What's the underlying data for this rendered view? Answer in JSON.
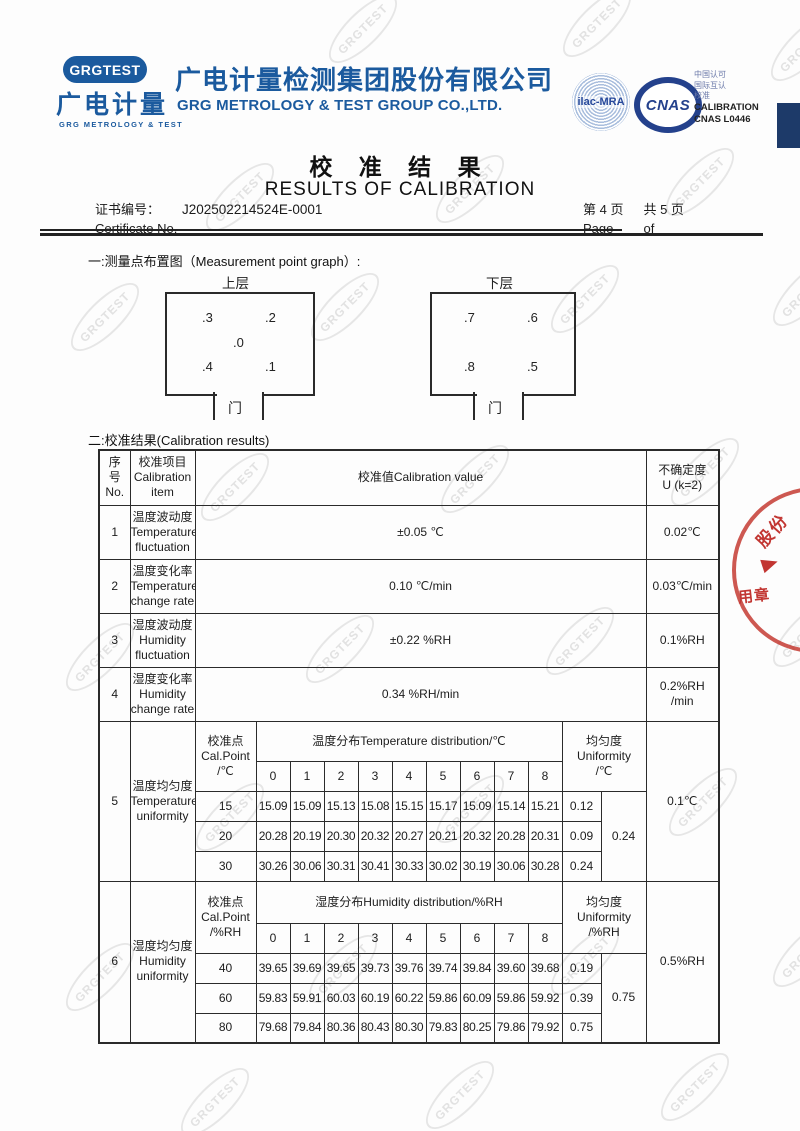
{
  "header": {
    "logo": {
      "badge": "GRGTEST",
      "cn": "广电计量",
      "en": "GRG METROLOGY & TEST"
    },
    "company": {
      "cn": "广电计量检测集团股份有限公司",
      "en": "GRG METROLOGY & TEST GROUP CO.,LTD."
    },
    "marks": {
      "ilac": "ilac-MRA",
      "cnas": "CNAS",
      "accreditation_lines": [
        "中国认可",
        "国际互认",
        "校准"
      ],
      "calibration": "CALIBRATION",
      "cnas_no": "CNAS L0446"
    }
  },
  "title": {
    "cn": "校 准 结 果",
    "en": "RESULTS OF CALIBRATION"
  },
  "certificate": {
    "label_cn": "证书编号：",
    "number": "J202502214524E-0001",
    "label_en": "Certificate No.",
    "page": {
      "first": "第 4  页",
      "second": "共 5  页",
      "page_label": "Page",
      "of_label": "of"
    }
  },
  "sections": {
    "one": "一:测量点布置图（Measurement point graph）:",
    "two": "二:校准结果(Calibration results)"
  },
  "diagram": {
    "upper": {
      "title": "上层",
      "p_tl": ".3",
      "p_tr": ".2",
      "p_c": ".0",
      "p_bl": ".4",
      "p_br": ".1",
      "door": "门"
    },
    "lower": {
      "title": "下层",
      "p_tl": ".7",
      "p_tr": ".6",
      "p_bl": ".8",
      "p_br": ".5",
      "door": "门"
    }
  },
  "table": {
    "header": {
      "no": [
        "序",
        "号",
        "No."
      ],
      "item": [
        "校准项目",
        "Calibration",
        "item"
      ],
      "value": "校准值Calibration value",
      "unc": [
        "不确定度",
        "U (k=2)"
      ]
    },
    "simple_rows": [
      {
        "no": "1",
        "item_cn": "温度波动度",
        "item_en1": "Temperature",
        "item_en2": "fluctuation",
        "value": "±0.05 ℃",
        "unc1": "0.02℃",
        "unc2": ""
      },
      {
        "no": "2",
        "item_cn": "温度变化率",
        "item_en1": "Temperature",
        "item_en2": "change rate",
        "value": "0.10 ℃/min",
        "unc1": "0.03℃/min",
        "unc2": ""
      },
      {
        "no": "3",
        "item_cn": "湿度波动度",
        "item_en1": "Humidity",
        "item_en2": "fluctuation",
        "value": "±0.22 %RH",
        "unc1": "0.1%RH",
        "unc2": ""
      },
      {
        "no": "4",
        "item_cn": "湿度变化率",
        "item_en1": "Humidity",
        "item_en2": "change rate",
        "value": "0.34 %RH/min",
        "unc1": "0.2%RH",
        "unc2": "/min"
      }
    ],
    "uniformity": [
      {
        "no": "5",
        "item_cn": "温度均匀度",
        "item_en1": "Temperature",
        "item_en2": "uniformity",
        "cal_point": [
          "校准点",
          "Cal.Point",
          "/℃"
        ],
        "dist_title": "温度分布Temperature distribution/℃",
        "uni_title": [
          "均匀度",
          "Uniformity",
          "/℃"
        ],
        "cols": [
          "0",
          "1",
          "2",
          "3",
          "4",
          "5",
          "6",
          "7",
          "8"
        ],
        "rows": [
          {
            "point": "15",
            "v": [
              "15.09",
              "15.09",
              "15.13",
              "15.08",
              "15.15",
              "15.17",
              "15.09",
              "15.14",
              "15.21"
            ],
            "u": "0.12"
          },
          {
            "point": "20",
            "v": [
              "20.28",
              "20.19",
              "20.30",
              "20.32",
              "20.27",
              "20.21",
              "20.32",
              "20.28",
              "20.31"
            ],
            "u": "0.09"
          },
          {
            "point": "30",
            "v": [
              "30.26",
              "30.06",
              "30.31",
              "30.41",
              "30.33",
              "30.02",
              "30.19",
              "30.06",
              "30.28"
            ],
            "u": "0.24"
          }
        ],
        "overall": "0.24",
        "unc": "0.1℃"
      },
      {
        "no": "6",
        "item_cn": "湿度均匀度",
        "item_en1": "Humidity",
        "item_en2": "uniformity",
        "cal_point": [
          "校准点",
          "Cal.Point",
          "/%RH"
        ],
        "dist_title": "湿度分布Humidity  distribution/%RH",
        "uni_title": [
          "均匀度",
          "Uniformity",
          "/%RH"
        ],
        "cols": [
          "0",
          "1",
          "2",
          "3",
          "4",
          "5",
          "6",
          "7",
          "8"
        ],
        "rows": [
          {
            "point": "40",
            "v": [
              "39.65",
              "39.69",
              "39.65",
              "39.73",
              "39.76",
              "39.74",
              "39.84",
              "39.60",
              "39.68"
            ],
            "u": "0.19"
          },
          {
            "point": "60",
            "v": [
              "59.83",
              "59.91",
              "60.03",
              "60.19",
              "60.22",
              "59.86",
              "60.09",
              "59.86",
              "59.92"
            ],
            "u": "0.39"
          },
          {
            "point": "80",
            "v": [
              "79.68",
              "79.84",
              "80.36",
              "80.43",
              "80.30",
              "79.83",
              "80.25",
              "79.86",
              "79.92"
            ],
            "u": "0.75"
          }
        ],
        "overall": "0.75",
        "unc": "0.5%RH"
      }
    ]
  },
  "stamp": {
    "text1": "股份",
    "text2": "用章"
  },
  "watermark": {
    "text": "GRGTEST"
  }
}
